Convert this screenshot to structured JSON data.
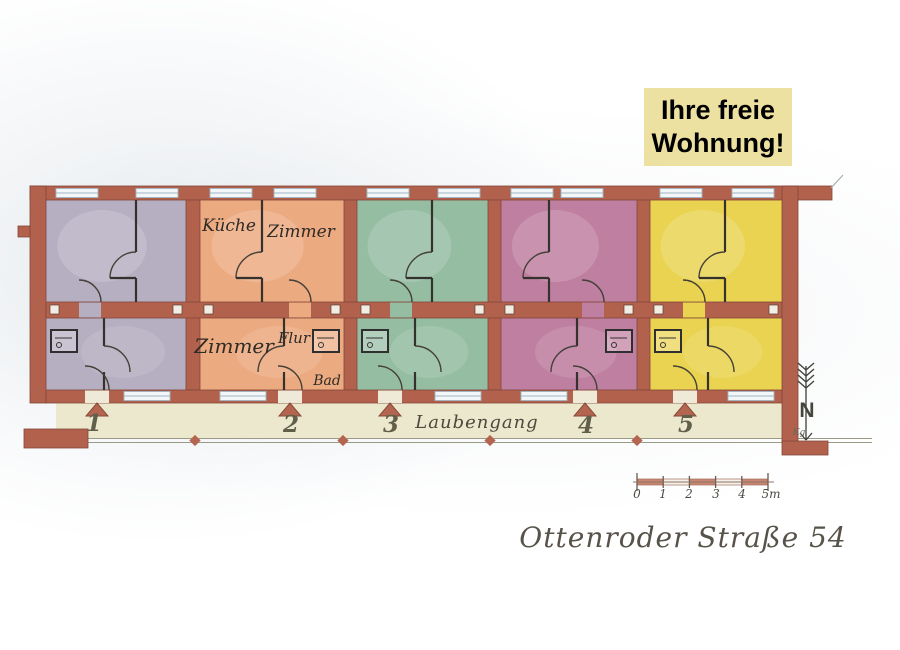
{
  "banner": {
    "line1": "Ihre freie",
    "line2": "Wohnung!",
    "bg_color": "#ece1a1",
    "text_color": "#000000"
  },
  "floor_plan": {
    "apartments": [
      {
        "number": "1",
        "color": "#b6aec1"
      },
      {
        "number": "2",
        "color": "#ecaa80",
        "rooms": {
          "kitchen": "Küche",
          "room_upper": "Zimmer",
          "room_lower": "Zimmer",
          "hallway": "Flur",
          "bathroom": "Bad"
        }
      },
      {
        "number": "3",
        "color": "#94bda2"
      },
      {
        "number": "4",
        "color": "#bf7fa0"
      },
      {
        "number": "5",
        "color": "#e9d350"
      }
    ],
    "walkway_label": "Laubengang",
    "wall_color": "#b2614d",
    "walkway_color": "#ece8cd",
    "north_arrow_label": "N",
    "author_initials": "Kg"
  },
  "scale_bar": {
    "tick_labels": [
      "0",
      "1",
      "2",
      "3",
      "4",
      "5m"
    ]
  },
  "address": "Ottenroder Straße 54"
}
